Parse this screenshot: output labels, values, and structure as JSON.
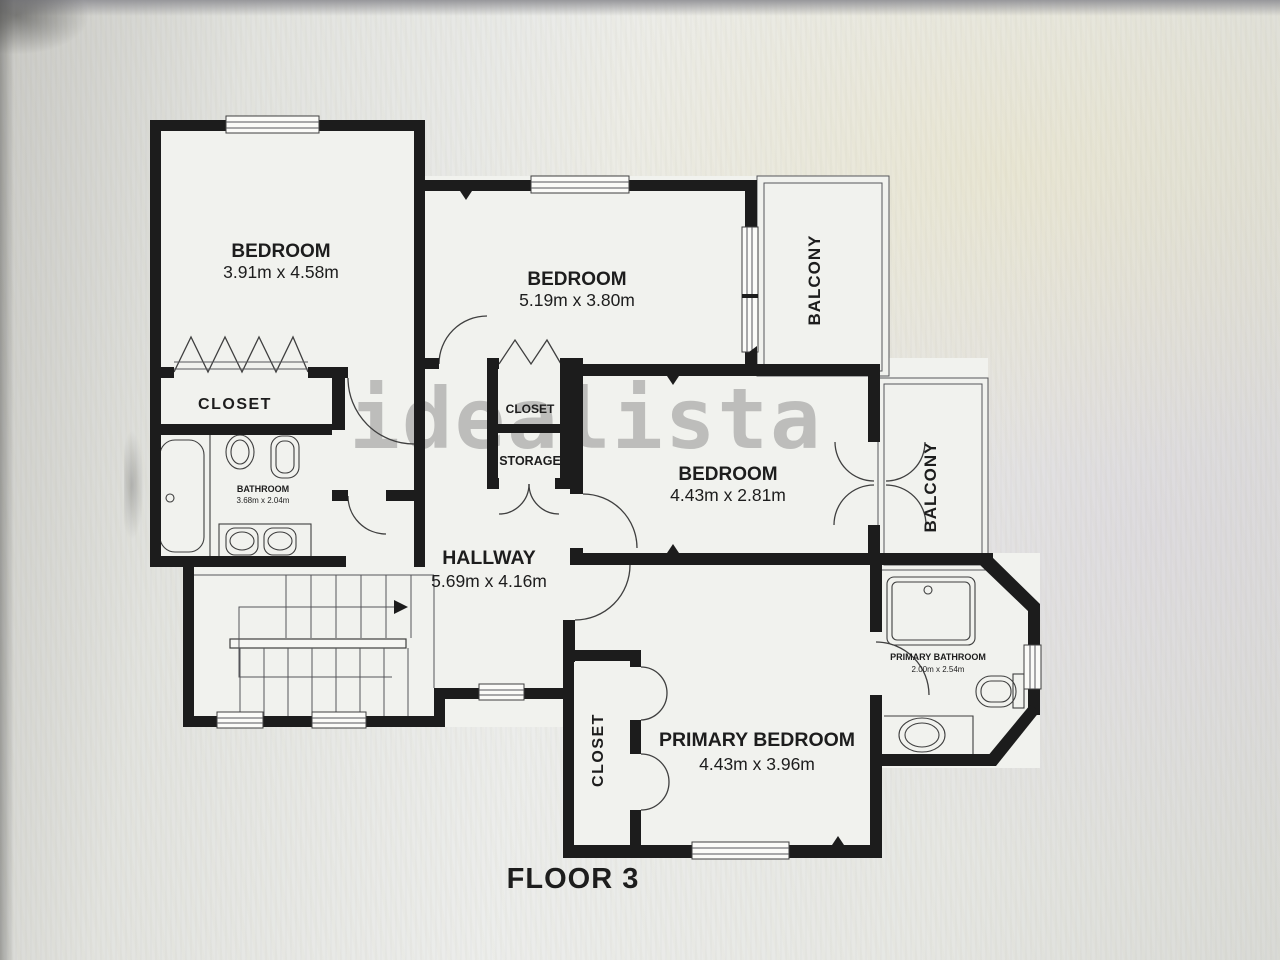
{
  "photo": {
    "floor_label": "FLOOR 3",
    "watermark": "idealista"
  },
  "rooms": {
    "bedroom_top_left": {
      "label": "BEDROOM",
      "dimensions": "3.91m x 4.58m"
    },
    "bedroom_top_middle": {
      "label": "BEDROOM",
      "dimensions": "5.19m x 3.80m"
    },
    "bedroom_middle_right": {
      "label": "BEDROOM",
      "dimensions": "4.43m x 2.81m"
    },
    "primary_bedroom": {
      "label": "PRIMARY BEDROOM",
      "dimensions": "4.43m x 3.96m"
    },
    "hallway": {
      "label": "HALLWAY",
      "dimensions": "5.69m x 4.16m"
    },
    "bathroom": {
      "label": "BATHROOM",
      "dimensions": "3.68m x 2.04m"
    },
    "primary_bathroom": {
      "label": "PRIMARY BATHROOM",
      "dimensions": "2.00m x 2.54m"
    },
    "closet_top_left": {
      "label": "CLOSET"
    },
    "closet_center": {
      "label": "CLOSET"
    },
    "storage": {
      "label": "STORAGE"
    },
    "closet_primary": {
      "label": "CLOSET"
    },
    "balcony_top": {
      "label": "BALCONY"
    },
    "balcony_right": {
      "label": "BALCONY"
    }
  },
  "colors": {
    "wall": "#1c1c1c",
    "paper": "#f1f2ee",
    "background": "#e2e3df",
    "line": "#3f3f3f",
    "watermark": "#8a8a8a",
    "text": "#1d1d1d"
  }
}
